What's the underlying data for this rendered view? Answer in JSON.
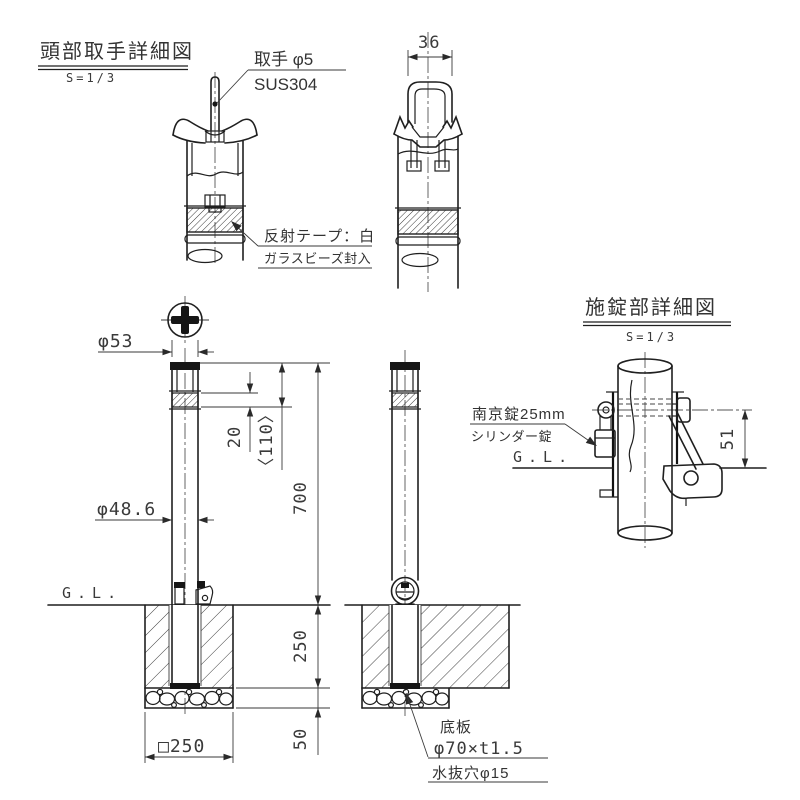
{
  "meta": {
    "bg": "#ffffff",
    "line_color": "#1f1f1f",
    "text_color": "#3a3a3a"
  },
  "head_detail": {
    "title": "頭部取手詳細図",
    "scale": "S=1/3",
    "handle_width": "36",
    "handle_note_top": "取手 φ5",
    "handle_note_bottom": "SUS304",
    "tape_note_top": "反射テープ：白",
    "tape_note_bottom": "ガラスビーズ封入"
  },
  "elevation": {
    "cap_dia": "φ53",
    "tape_width": "20",
    "tape_offset": "〈110〉",
    "height_above_ground": "700",
    "pipe_dia": "φ48.6",
    "ground_label": "G.L.",
    "embed_depth": "250",
    "gravel_depth": "50",
    "footing_width": "□250",
    "base_note_1": "底板",
    "base_note_2": "φ70×t1.5",
    "base_note_3": "水抜穴φ15"
  },
  "lock_detail": {
    "title": "施錠部詳細図",
    "scale": "S=1/3",
    "lock_note_top": "南京錠25mm",
    "lock_note_bottom": "シリンダー錠",
    "ground_label": "G.L.",
    "pin_height": "51"
  }
}
